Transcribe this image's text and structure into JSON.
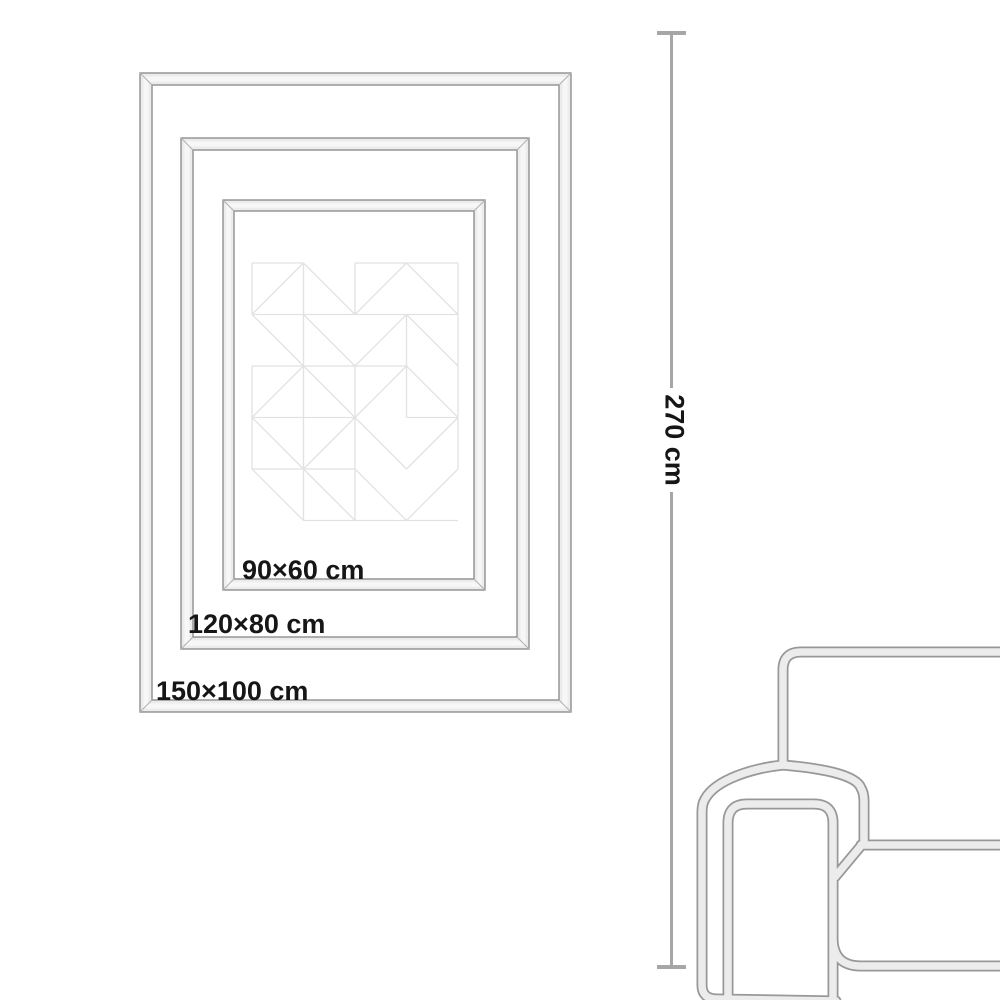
{
  "size_guide": {
    "frames": [
      {
        "size_label": "150×100 cm"
      },
      {
        "size_label": "120×80 cm"
      },
      {
        "size_label": "90×60 cm"
      }
    ],
    "wall_height": {
      "label": "270 cm"
    },
    "colors": {
      "frame_outline": "#8f8f8f",
      "frame_fill": "#ececec",
      "frame_highlight": "#f7f7f7",
      "miter_line": "#b3b3b3",
      "label_text": "#161616",
      "dimension_line": "#a6a6a6",
      "artwork_lines": "#e2e2e2",
      "sofa_outline": "#989898",
      "sofa_fill": "#ececec"
    }
  }
}
